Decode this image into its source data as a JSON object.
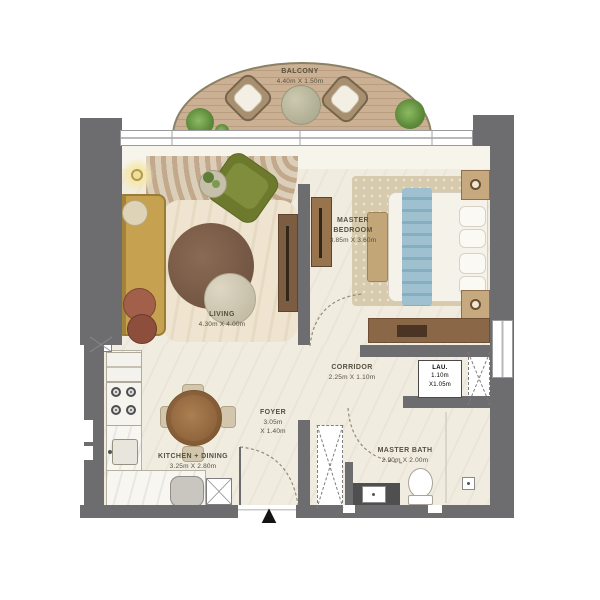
{
  "rooms": {
    "balcony": {
      "name": "BALCONY",
      "dims": "4.40m X 1.50m"
    },
    "living": {
      "name": "LIVING",
      "dims": "4.30m X 4.00m"
    },
    "master_bedroom": {
      "name": "MASTER BEDROOM",
      "dims": "3.85m X 3.60m"
    },
    "corridor": {
      "name": "CORRIDOR",
      "dims": "2.25m X 1.10m"
    },
    "foyer": {
      "name": "FOYER",
      "dims_line1": "3.05m",
      "dims_line2": "X 1.40m"
    },
    "laundry": {
      "name": "LAU.",
      "dims_line1": "1.10m",
      "dims_line2": "X1.05m"
    },
    "kitchen_dining": {
      "name": "KITCHEN + DINING",
      "dims": "3.25m X 2.80m"
    },
    "master_bath": {
      "name": "MASTER BATH",
      "dims": "2.90m X 2.00m"
    }
  },
  "entry": {
    "marker": "▲"
  },
  "colors": {
    "wall": "#6d6d70",
    "floor": "#f1ece0",
    "deck_wood": "#c9ad8f",
    "sofa_mustard": "#c5a150",
    "armchair_green": "#6d7a2d",
    "bed_runner_blue": "#8fb3c5",
    "wood_furniture": "#8a6847",
    "label_text": "#56503f"
  }
}
